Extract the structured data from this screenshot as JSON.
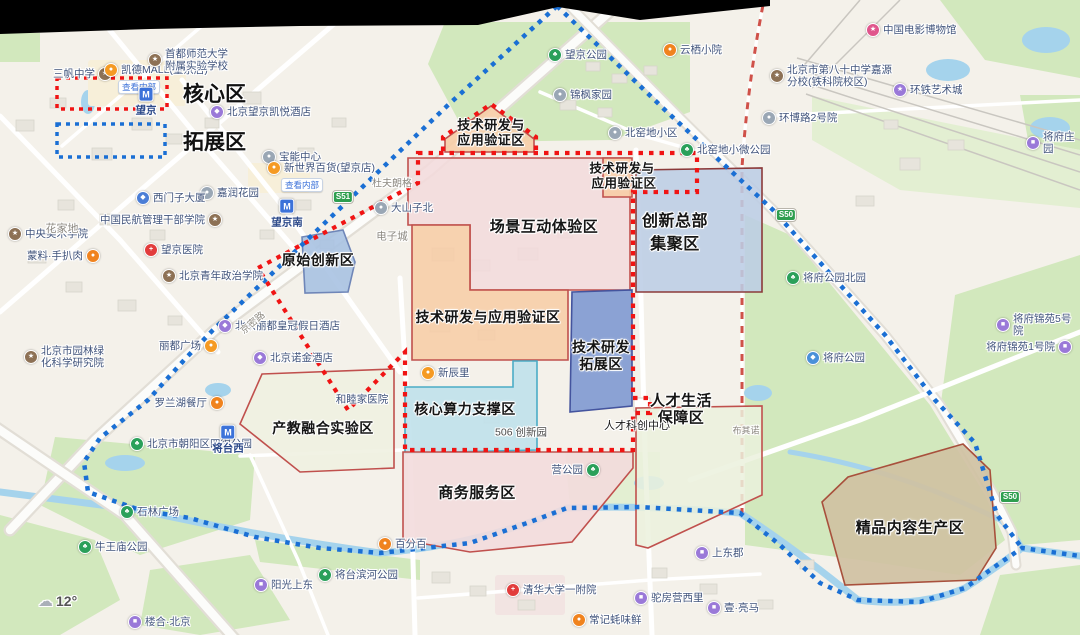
{
  "legend": {
    "items": [
      {
        "label": "核心区",
        "color": "#f01414",
        "box": [
          57,
          78,
          110,
          31
        ],
        "label_x": 183,
        "label_y": 93
      },
      {
        "label": "拓展区",
        "color": "#1a6fd4",
        "box": [
          57,
          124,
          108,
          33
        ],
        "label_x": 183,
        "label_y": 141
      }
    ]
  },
  "weather": {
    "icon": "cloud-icon",
    "temp": "12°"
  },
  "boundaries": {
    "core": {
      "color": "#f01414",
      "paths": [
        {
          "closed": true,
          "pts": [
            [
              418,
              153
            ],
            [
              697,
              153
            ],
            [
              697,
              192
            ],
            [
              633,
              192
            ],
            [
              633,
              398
            ],
            [
              650,
              398
            ],
            [
              650,
              413
            ],
            [
              633,
              413
            ],
            [
              633,
              450
            ],
            [
              405,
              450
            ],
            [
              405,
              352
            ],
            [
              348,
              410
            ],
            [
              258,
              268
            ],
            [
              418,
              183
            ]
          ]
        },
        {
          "closed": false,
          "pts": [
            [
              443,
              151
            ],
            [
              443,
              137
            ],
            [
              491,
              104
            ],
            [
              536,
              137
            ],
            [
              536,
              151
            ]
          ]
        }
      ]
    },
    "expansion": {
      "color": "#1a6fd4",
      "paths": [
        {
          "closed": false,
          "pts": [
            [
              557,
              6
            ],
            [
              447,
              106
            ],
            [
              330,
              218
            ],
            [
              213,
              330
            ],
            [
              186,
              358
            ],
            [
              148,
              400
            ],
            [
              100,
              438
            ],
            [
              84,
              462
            ],
            [
              88,
              492
            ],
            [
              140,
              510
            ],
            [
              190,
              518
            ],
            [
              255,
              537
            ],
            [
              320,
              548
            ],
            [
              380,
              553
            ],
            [
              470,
              543
            ],
            [
              530,
              522
            ],
            [
              567,
              508
            ],
            [
              640,
              507
            ],
            [
              740,
              513
            ],
            [
              780,
              545
            ],
            [
              820,
              583
            ],
            [
              858,
              600
            ],
            [
              920,
              602
            ],
            [
              965,
              588
            ],
            [
              1000,
              563
            ],
            [
              1022,
              548
            ],
            [
              1080,
              556
            ]
          ]
        },
        {
          "closed": false,
          "pts": [
            [
              557,
              6
            ],
            [
              665,
              110
            ],
            [
              773,
              210
            ],
            [
              885,
              335
            ],
            [
              935,
              400
            ],
            [
              975,
              443
            ],
            [
              997,
              515
            ],
            [
              1022,
              548
            ]
          ]
        }
      ]
    }
  },
  "zones": [
    {
      "name": "scene-interaction-zone",
      "fill": "#f3dbdc",
      "border": "#c0504d",
      "opacity": 0.88,
      "pts": [
        [
          408,
          158
        ],
        [
          630,
          158
        ],
        [
          630,
          290
        ],
        [
          470,
          290
        ],
        [
          470,
          225
        ],
        [
          408,
          225
        ]
      ],
      "labels": [
        {
          "t": "场景互动体验区",
          "x": 544,
          "y": 226,
          "s": 15
        }
      ]
    },
    {
      "name": "tech-rd-validation-north",
      "fill": "#f7cda6",
      "border": "#c0504d",
      "opacity": 0.9,
      "pts": [
        [
          445,
          152
        ],
        [
          445,
          139
        ],
        [
          491,
          106
        ],
        [
          534,
          139
        ],
        [
          534,
          152
        ]
      ],
      "labels": [
        {
          "t": "技术研发与",
          "x": 491,
          "y": 124,
          "s": 13
        },
        {
          "t": "应用验证区",
          "x": 491,
          "y": 139,
          "s": 13
        }
      ]
    },
    {
      "name": "tech-rd-validation-small",
      "fill": "#f7cda6",
      "border": "#c0504d",
      "opacity": 0.9,
      "pts": [
        [
          603,
          158
        ],
        [
          632,
          158
        ],
        [
          632,
          197
        ],
        [
          603,
          197
        ]
      ],
      "labels": [
        {
          "t": "技术研发与",
          "x": 622,
          "y": 167,
          "s": 12.5
        },
        {
          "t": "应用验证区",
          "x": 624,
          "y": 182,
          "s": 12.5
        }
      ]
    },
    {
      "name": "innovation-hq-zone",
      "fill": "#bccde5",
      "border": "#8b3a3a",
      "opacity": 0.88,
      "pts": [
        [
          636,
          170
        ],
        [
          762,
          168
        ],
        [
          762,
          292
        ],
        [
          636,
          292
        ]
      ],
      "labels": [
        {
          "t": "创新总部",
          "x": 675,
          "y": 219,
          "s": 16
        },
        {
          "t": "集聚区",
          "x": 675,
          "y": 242,
          "s": 16
        }
      ]
    },
    {
      "name": "original-innovation-zone",
      "fill": "#a9c2e2",
      "border": "#6f86b8",
      "opacity": 0.9,
      "pts": [
        [
          302,
          237
        ],
        [
          343,
          230
        ],
        [
          355,
          262
        ],
        [
          348,
          292
        ],
        [
          305,
          293
        ]
      ],
      "labels": [
        {
          "t": "原始创新区",
          "x": 318,
          "y": 260,
          "s": 14
        }
      ]
    },
    {
      "name": "tech-rd-validation-mid",
      "fill": "#f7cda6",
      "border": "#c0504d",
      "opacity": 0.88,
      "pts": [
        [
          412,
          225
        ],
        [
          470,
          225
        ],
        [
          470,
          290
        ],
        [
          568,
          290
        ],
        [
          568,
          360
        ],
        [
          412,
          360
        ]
      ],
      "labels": [
        {
          "t": "技术研发与应用验证区",
          "x": 488,
          "y": 317,
          "s": 14
        }
      ]
    },
    {
      "name": "tech-rd-expansion-zone",
      "fill": "#8099d1",
      "border": "#44549e",
      "opacity": 0.9,
      "pts": [
        [
          572,
          292
        ],
        [
          632,
          290
        ],
        [
          632,
          406
        ],
        [
          570,
          412
        ]
      ],
      "labels": [
        {
          "t": "技术研发",
          "x": 601,
          "y": 347,
          "s": 14
        },
        {
          "t": "拓展区",
          "x": 601,
          "y": 364,
          "s": 14
        }
      ]
    },
    {
      "name": "core-computing-zone",
      "fill": "#c0e1eb",
      "border": "#4bacc6",
      "opacity": 0.9,
      "pts": [
        [
          405,
          387
        ],
        [
          513,
          387
        ],
        [
          513,
          361
        ],
        [
          537,
          361
        ],
        [
          537,
          450
        ],
        [
          405,
          453
        ]
      ],
      "labels": [
        {
          "t": "核心算力支撑区",
          "x": 465,
          "y": 409,
          "s": 14
        }
      ]
    },
    {
      "name": "talent-life-zone",
      "fill": "#ebf1dd",
      "border": "#c0504d",
      "opacity": 0.85,
      "pts": [
        [
          636,
          408
        ],
        [
          762,
          406
        ],
        [
          762,
          495
        ],
        [
          648,
          548
        ],
        [
          636,
          545
        ]
      ],
      "labels": [
        {
          "t": "人才生活",
          "x": 681,
          "y": 400,
          "s": 15
        },
        {
          "t": "保障区",
          "x": 681,
          "y": 417,
          "s": 15
        }
      ]
    },
    {
      "name": "industry-education-zone",
      "fill": "#eff0e0",
      "border": "#c0504d",
      "opacity": 0.88,
      "pts": [
        [
          262,
          374
        ],
        [
          394,
          369
        ],
        [
          394,
          468
        ],
        [
          300,
          472
        ],
        [
          240,
          424
        ]
      ],
      "labels": [
        {
          "t": "产教融合实验区",
          "x": 323,
          "y": 428,
          "s": 14
        }
      ]
    },
    {
      "name": "business-service-zone",
      "fill": "#f3dbdc",
      "border": "#c0504d",
      "opacity": 0.88,
      "pts": [
        [
          403,
          452
        ],
        [
          633,
          452
        ],
        [
          633,
          468
        ],
        [
          572,
          542
        ],
        [
          470,
          552
        ],
        [
          403,
          540
        ]
      ],
      "labels": [
        {
          "t": "商务服务区",
          "x": 477,
          "y": 492,
          "s": 15
        }
      ]
    },
    {
      "name": "premium-content-zone",
      "fill": "#cfc1a2",
      "border": "#a8503c",
      "opacity": 0.92,
      "pts": [
        [
          963,
          444
        ],
        [
          990,
          470
        ],
        [
          996,
          548
        ],
        [
          976,
          580
        ],
        [
          845,
          585
        ],
        [
          822,
          502
        ],
        [
          848,
          477
        ]
      ],
      "labels": [
        {
          "t": "精品内容生产区",
          "x": 910,
          "y": 527,
          "s": 15
        }
      ]
    }
  ],
  "icon_styles": {
    "park": {
      "bg": "#2aa05a",
      "glyph": "♣"
    },
    "school": {
      "bg": "#8d7155",
      "glyph": "★"
    },
    "hospital": {
      "bg": "#e23c3c",
      "glyph": "+"
    },
    "mall": {
      "bg": "#f59a23",
      "glyph": "●"
    },
    "food": {
      "bg": "#f0831e",
      "glyph": "●"
    },
    "hotel": {
      "bg": "#9a79d8",
      "glyph": "◆"
    },
    "residential": {
      "bg": "#9a79d8",
      "glyph": "■"
    },
    "gray": {
      "bg": "#9aa7b5",
      "glyph": "●"
    },
    "company": {
      "bg": "#4a7dd6",
      "glyph": "◆"
    },
    "museum": {
      "bg": "#e0558c",
      "glyph": "★"
    },
    "art": {
      "bg": "#9a79d8",
      "glyph": "★"
    },
    "scenic": {
      "bg": "#4a90d9",
      "glyph": "◆"
    }
  },
  "pois": [
    {
      "label": "三帆中学",
      "type": "school",
      "x": 112,
      "y": 74,
      "side": "l"
    },
    {
      "label": "凯德MALL(望京店)",
      "type": "mall",
      "x": 104,
      "y": 79,
      "side": "r",
      "tag": "查看内部"
    },
    {
      "label": "首都师范大学\n附属实验学校",
      "type": "school",
      "x": 148,
      "y": 60,
      "side": "r"
    },
    {
      "label": "北京望京凯悦酒店",
      "type": "hotel",
      "x": 210,
      "y": 112,
      "side": "r"
    },
    {
      "label": "望京",
      "type": "metro",
      "x": 146,
      "y": 99
    },
    {
      "label": "望京公园",
      "type": "park",
      "x": 548,
      "y": 55,
      "side": "r"
    },
    {
      "label": "云栖小院",
      "type": "food",
      "x": 663,
      "y": 50,
      "side": "r"
    },
    {
      "label": "中国电影博物馆",
      "type": "museum",
      "x": 866,
      "y": 30,
      "side": "r"
    },
    {
      "label": "北京市第八十中学嘉源\n分校(铁科院校区)",
      "type": "school",
      "x": 770,
      "y": 76,
      "side": "r"
    },
    {
      "label": "环铁艺术城",
      "type": "art",
      "x": 893,
      "y": 90,
      "side": "r"
    },
    {
      "label": "环博路2号院",
      "type": "gray",
      "x": 762,
      "y": 118,
      "side": "r"
    },
    {
      "label": "将府庄园",
      "type": "residential",
      "x": 1026,
      "y": 143,
      "side": "r"
    },
    {
      "label": "锦枫家园",
      "type": "gray",
      "x": 553,
      "y": 95,
      "side": "r"
    },
    {
      "label": "北窑地小区",
      "type": "gray",
      "x": 608,
      "y": 133,
      "side": "r"
    },
    {
      "label": "北窑地小微公园",
      "type": "park",
      "x": 680,
      "y": 150,
      "side": "r"
    },
    {
      "label": "宝能中心",
      "type": "gray",
      "x": 262,
      "y": 157,
      "side": "r"
    },
    {
      "label": "新世界百货(望京店)",
      "type": "mall",
      "x": 267,
      "y": 177,
      "side": "r",
      "tag": "查看内部"
    },
    {
      "label": "嘉润花园",
      "type": "gray",
      "x": 200,
      "y": 193,
      "side": "r"
    },
    {
      "label": "西门子大厦",
      "type": "company",
      "x": 136,
      "y": 198,
      "side": "r"
    },
    {
      "label": "中国民航管理干部学院",
      "type": "school",
      "x": 222,
      "y": 220,
      "side": "l"
    },
    {
      "label": "望京南",
      "type": "metro",
      "x": 287,
      "y": 211
    },
    {
      "label": "大山子北",
      "type": "gray",
      "x": 374,
      "y": 208,
      "side": "r"
    },
    {
      "label": "中央美术学院",
      "type": "school",
      "x": 8,
      "y": 234,
      "side": "r"
    },
    {
      "label": "蒙料·手扒肉",
      "type": "food",
      "x": 100,
      "y": 256,
      "side": "l"
    },
    {
      "label": "望京医院",
      "type": "hospital",
      "x": 144,
      "y": 250,
      "side": "r"
    },
    {
      "label": "北京青年政治学院",
      "type": "school",
      "x": 162,
      "y": 276,
      "side": "r"
    },
    {
      "label": "北京市园林绿\n化科学研究院",
      "type": "school",
      "x": 24,
      "y": 357,
      "side": "r"
    },
    {
      "label": "北京丽都皇冠假日酒店",
      "type": "hotel",
      "x": 218,
      "y": 326,
      "side": "r"
    },
    {
      "label": "丽都广场",
      "type": "mall",
      "x": 218,
      "y": 346,
      "side": "l"
    },
    {
      "label": "北京诺金酒店",
      "type": "hotel",
      "x": 253,
      "y": 358,
      "side": "r"
    },
    {
      "label": "罗兰湖餐厅",
      "type": "food",
      "x": 224,
      "y": 403,
      "side": "l"
    },
    {
      "label": "北京市朝阳区四得公园",
      "type": "park",
      "x": 130,
      "y": 444,
      "side": "r"
    },
    {
      "label": "将台西",
      "type": "metro",
      "x": 228,
      "y": 437
    },
    {
      "label": "石林广场",
      "type": "park",
      "x": 120,
      "y": 512,
      "side": "r"
    },
    {
      "label": "牛王庙公园",
      "type": "park",
      "x": 78,
      "y": 547,
      "side": "r"
    },
    {
      "label": "楼合·北京",
      "type": "residential",
      "x": 128,
      "y": 622,
      "side": "r"
    },
    {
      "label": "阳光上东",
      "type": "residential",
      "x": 254,
      "y": 585,
      "side": "r"
    },
    {
      "label": "将台滨河公园",
      "type": "park",
      "x": 318,
      "y": 575,
      "side": "r"
    },
    {
      "label": "百分百",
      "type": "food",
      "x": 378,
      "y": 544,
      "side": "r"
    },
    {
      "label": "新辰里",
      "type": "mall",
      "x": 421,
      "y": 373,
      "side": "r"
    },
    {
      "label": "营公园",
      "type": "park",
      "x": 600,
      "y": 470,
      "side": "l"
    },
    {
      "label": "清华大学一附院",
      "type": "hospital",
      "x": 506,
      "y": 590,
      "side": "r"
    },
    {
      "label": "常记蚝味鲜",
      "type": "food",
      "x": 572,
      "y": 620,
      "side": "r"
    },
    {
      "label": "驼房营西里",
      "type": "residential",
      "x": 634,
      "y": 598,
      "side": "r"
    },
    {
      "label": "壹·亮马",
      "type": "residential",
      "x": 707,
      "y": 608,
      "side": "r"
    },
    {
      "label": "上东郡",
      "type": "residential",
      "x": 695,
      "y": 553,
      "side": "r"
    },
    {
      "label": "将府公园北园",
      "type": "park",
      "x": 786,
      "y": 278,
      "side": "r"
    },
    {
      "label": "将府公园",
      "type": "scenic",
      "x": 806,
      "y": 358,
      "side": "r"
    },
    {
      "label": "将府锦苑5号院",
      "type": "residential",
      "x": 996,
      "y": 325,
      "side": "r"
    },
    {
      "label": "将府锦苑1号院",
      "type": "residential",
      "x": 1072,
      "y": 347,
      "side": "l"
    }
  ],
  "area_labels": [
    {
      "text": "花家地",
      "x": 62,
      "y": 228,
      "size": 11,
      "color": "#8c8880"
    },
    {
      "text": "电子城",
      "x": 392,
      "y": 236,
      "size": 10.5,
      "color": "#8c8880"
    },
    {
      "text": "杜夫朗格",
      "x": 392,
      "y": 182,
      "size": 10,
      "color": "#8c8880"
    },
    {
      "text": "和睦家医院",
      "x": 362,
      "y": 399,
      "size": 10.5,
      "color": "#41547c"
    },
    {
      "text": "506 创新园",
      "x": 521,
      "y": 432,
      "size": 10.5,
      "color": "#4a4a4a"
    },
    {
      "text": "人才科创中心",
      "x": 637,
      "y": 425,
      "size": 11,
      "color": "#1a1a1a"
    },
    {
      "text": "布其诺",
      "x": 746,
      "y": 430,
      "size": 9,
      "color": "#8c8880"
    },
    {
      "text": "京密路",
      "x": 252,
      "y": 322,
      "size": 9.5,
      "color": "#8f8b82",
      "rot": -40
    }
  ],
  "road_shields": [
    {
      "text": "S51",
      "x": 343,
      "y": 197
    },
    {
      "text": "S50",
      "x": 786,
      "y": 215
    },
    {
      "text": "S50",
      "x": 1010,
      "y": 497
    }
  ]
}
